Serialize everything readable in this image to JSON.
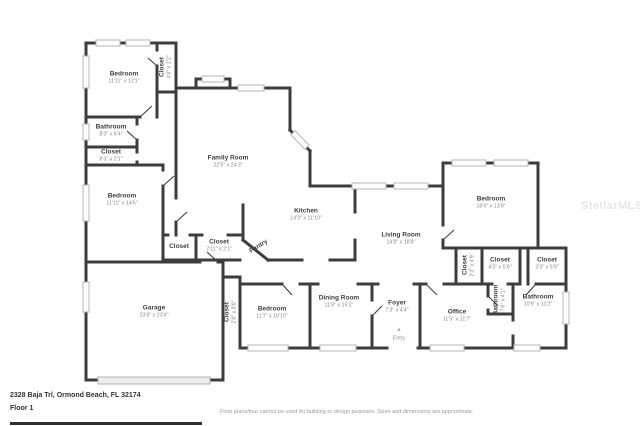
{
  "watermark": "StellarMLS",
  "entry_arrow": "▲",
  "footer": {
    "address": "2328 Baja Trl, Ormond Beach, FL 32174",
    "floor_label": "Floor 1",
    "disclaimer": "Floor plans/tour cannot be used for building or design purposes. Sizes and dimensions are approximate."
  },
  "colors": {
    "wall": "#3d3d3d",
    "window_border": "#b5b5b5",
    "garage_door": "#ededed",
    "room_name": "#3f3f3f",
    "room_dims": "#8a8a8a",
    "watermark": "#e6e6e6",
    "footer_text": "#333333",
    "disclaimer": "#999999",
    "footer_bar": "#2f2f2f"
  },
  "rooms": [
    {
      "name": "Bedroom",
      "dims": "11'11\" x 12'1\""
    },
    {
      "name": "Closet",
      "dims": "4'8\" x 2'2\""
    },
    {
      "name": "Bathroom",
      "dims": "8'3\" x 5'4\""
    },
    {
      "name": "Closet",
      "dims": "8'3\" x 2'1\""
    },
    {
      "name": "Bedroom",
      "dims": "11'11\" x 14'6\""
    },
    {
      "name": "Family Room",
      "dims": "22'5\" x 24'3\""
    },
    {
      "name": "Kitchen",
      "dims": "14'3\" x 11'10\""
    },
    {
      "name": "Pantry",
      "dims": ""
    },
    {
      "name": "Closet",
      "dims": ""
    },
    {
      "name": "Closet",
      "dims": "7'11\" x 2'1\""
    },
    {
      "name": "Living Room",
      "dims": "14'8\" x 18'8\""
    },
    {
      "name": "Bedroom",
      "dims": "18'6\" x 13'9\""
    },
    {
      "name": "Closet",
      "dims": "2'3\" x 4'9\""
    },
    {
      "name": "Closet",
      "dims": "4'3\" x 5'9\""
    },
    {
      "name": "Closet",
      "dims": "3'3\" x 5'9\""
    },
    {
      "name": "Garage",
      "dims": "23'8\" x 23'4\""
    },
    {
      "name": "Closet",
      "dims": "2'8\" x 8'8\""
    },
    {
      "name": "Bedroom",
      "dims": "11'7\" x 10'10\""
    },
    {
      "name": "Dining Room",
      "dims": "11'8\" x 15'3\""
    },
    {
      "name": "Foyer",
      "dims": "7'3\" x 4'4\""
    },
    {
      "name": "Entry",
      "dims": ""
    },
    {
      "name": "Office",
      "dims": "11'5\" x 11'7\""
    },
    {
      "name": "Bathroom",
      "dims": "7'6\" x 4'1\""
    },
    {
      "name": "Bathroom",
      "dims": "10'9\" x 11'2\""
    }
  ]
}
